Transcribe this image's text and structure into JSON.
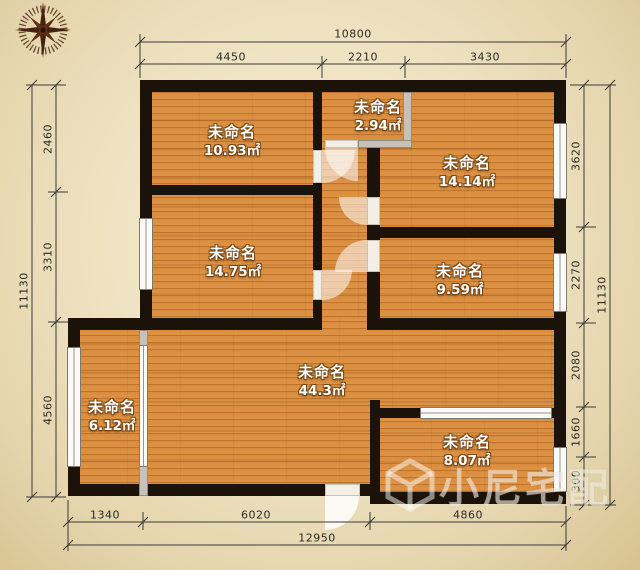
{
  "title": "floor-plan",
  "rooms": [
    {
      "name": "未命名",
      "area": "10.93㎡"
    },
    {
      "name": "未命名",
      "area": "2.94㎡"
    },
    {
      "name": "未命名",
      "area": "14.14㎡"
    },
    {
      "name": "未命名",
      "area": "14.75㎡"
    },
    {
      "name": "未命名",
      "area": "9.59㎡"
    },
    {
      "name": "未命名",
      "area": "44.3㎡"
    },
    {
      "name": "未命名",
      "area": "6.12㎡"
    },
    {
      "name": "未命名",
      "area": "8.07㎡"
    }
  ],
  "dimensions": {
    "top": {
      "total": "10800",
      "segments": [
        "4450",
        "2210",
        "3430"
      ]
    },
    "left": {
      "total": "11130",
      "segments": [
        "2460",
        "3310",
        "4560"
      ]
    },
    "right": {
      "total": "11130",
      "segments": [
        "3620",
        "2270",
        "2080",
        "1660",
        "300"
      ]
    },
    "bottom": {
      "total": "12950",
      "segments": [
        "1340",
        "6020",
        "4860"
      ]
    }
  },
  "watermark": {
    "text": "小尼宅配"
  },
  "icons": {
    "compass": "compass-rose",
    "watermark_logo": "cube-logo"
  },
  "colors": {
    "floor": "#d98c3e",
    "wall": "#1b1309",
    "background": "#eee2c1",
    "dimension_text": "#2b2b28",
    "compass": "#45220f",
    "room_text": "#ffffff",
    "watermark": "rgba(255,255,255,0.5)"
  }
}
